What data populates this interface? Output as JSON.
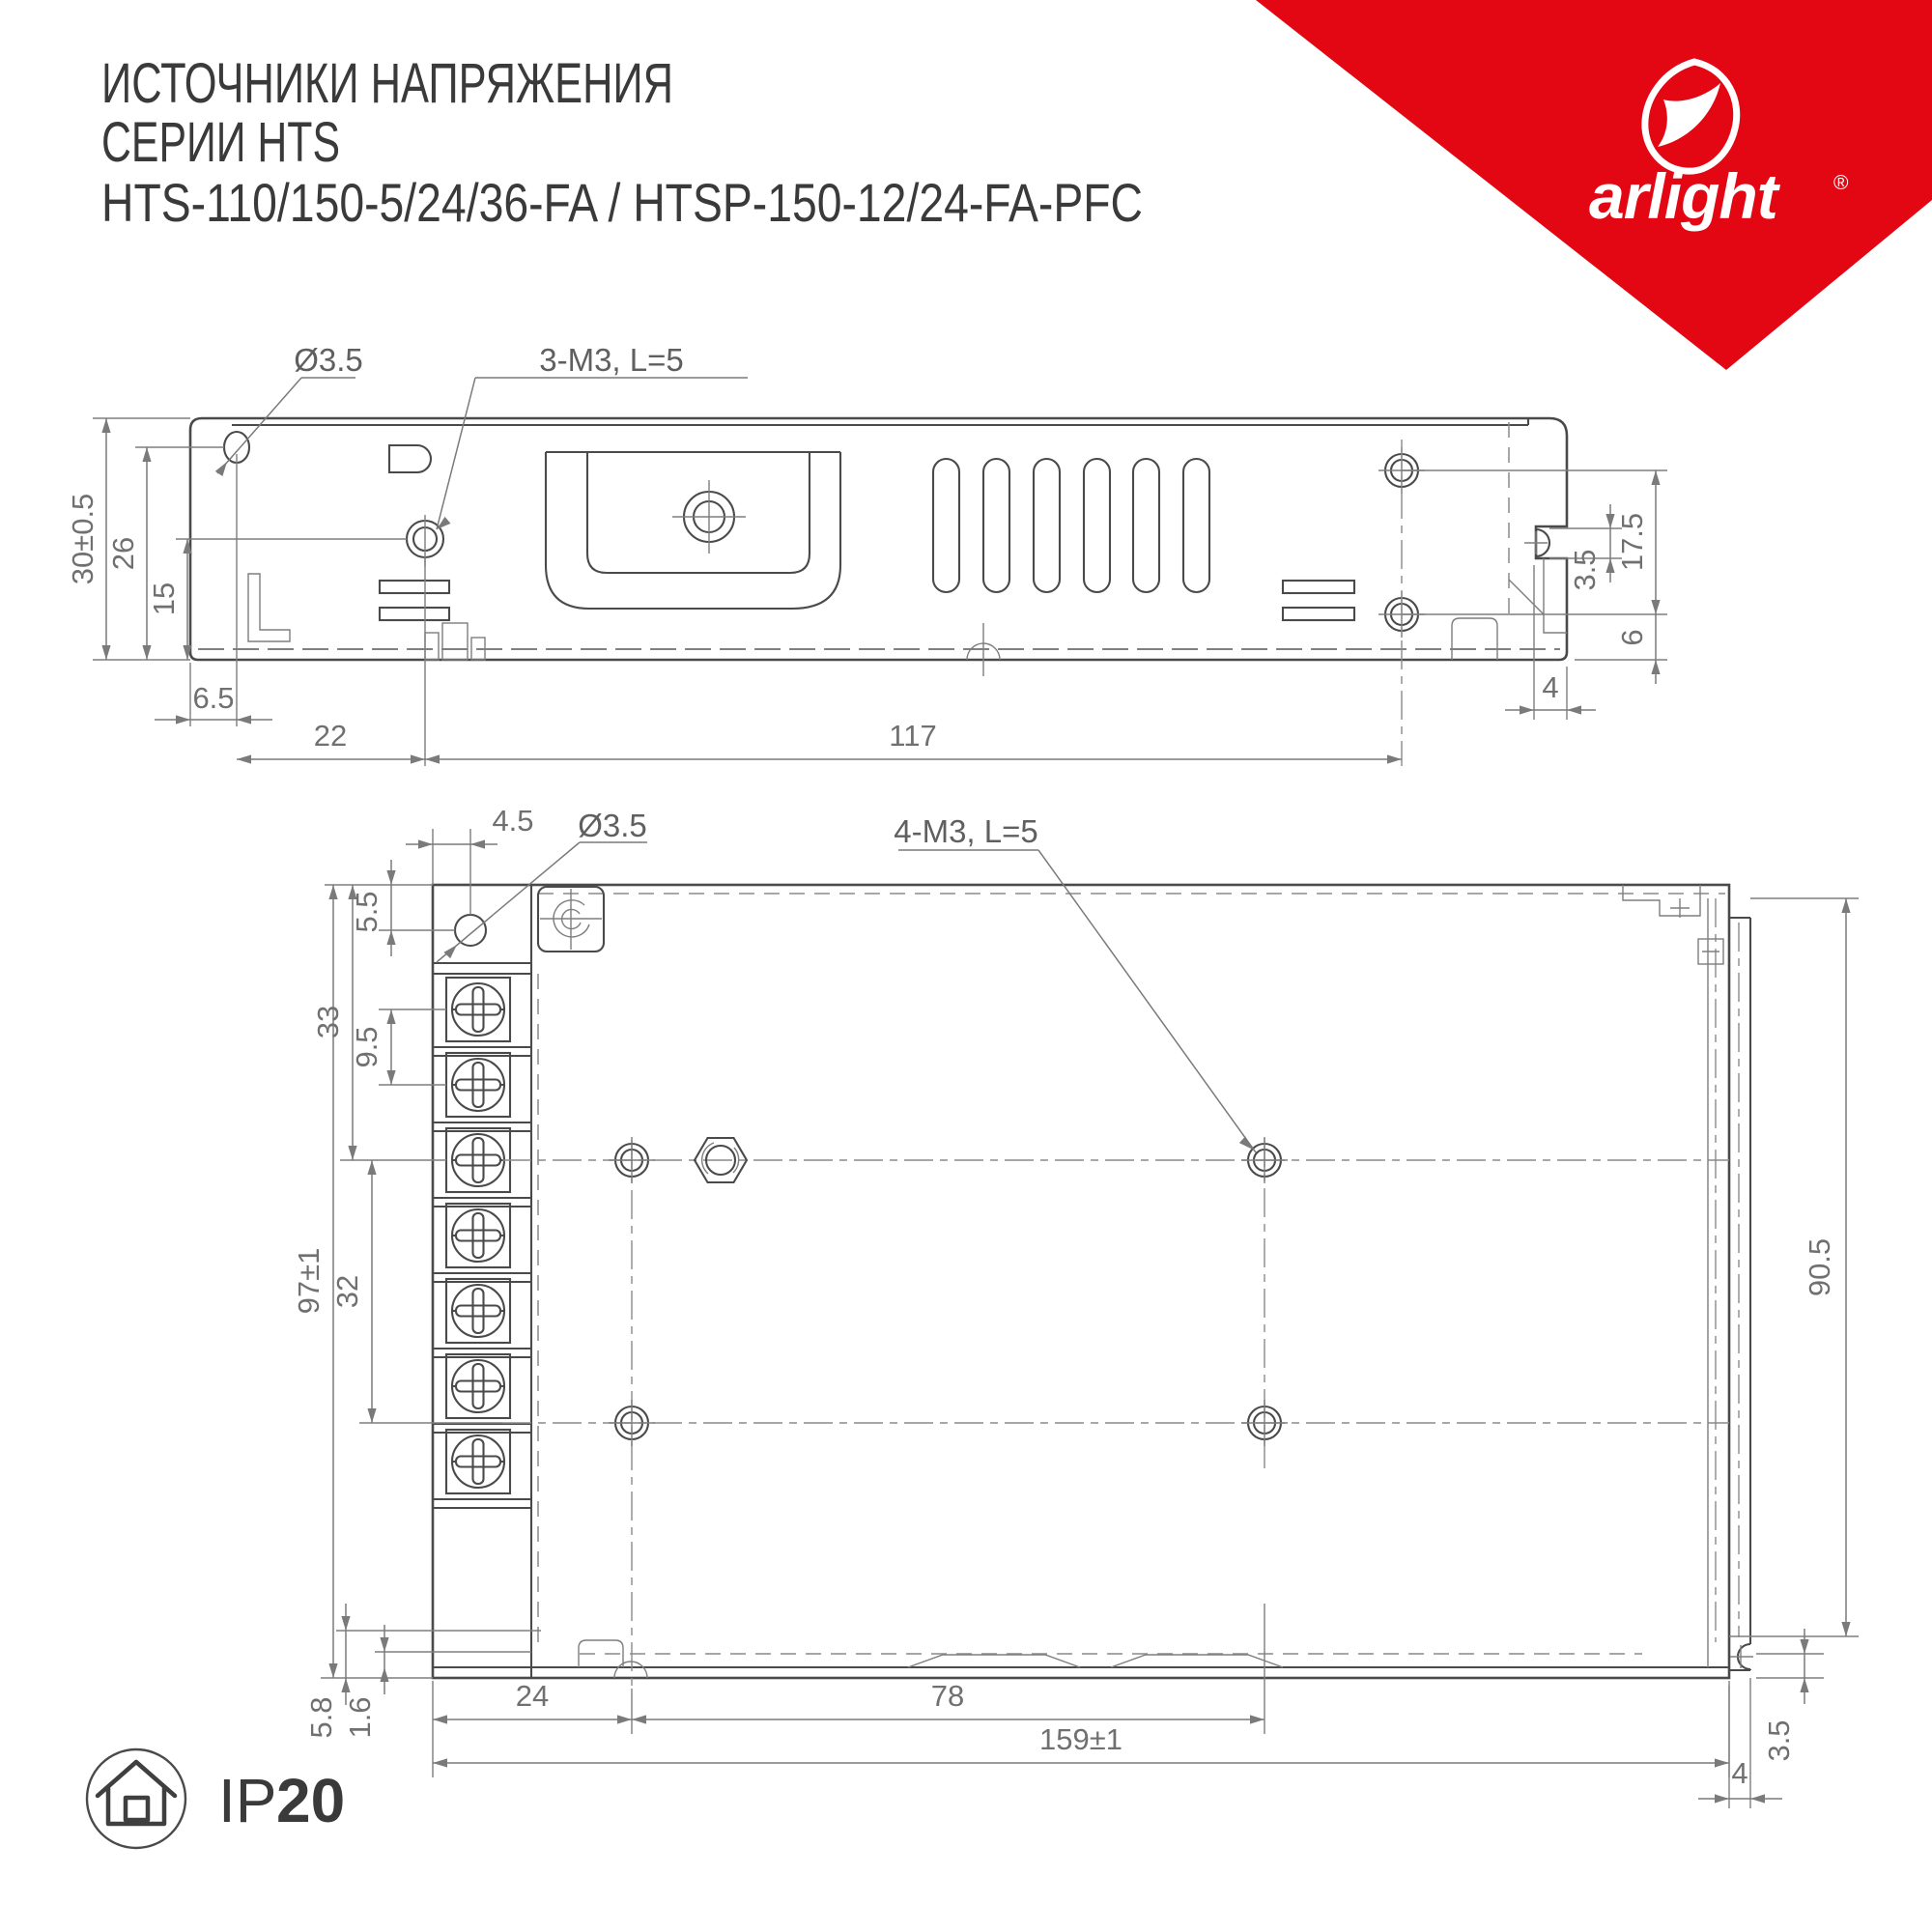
{
  "header": {
    "title_line1": "ИСТОЧНИКИ НАПРЯЖЕНИЯ",
    "title_line2": "СЕРИИ HTS",
    "title_line3": "HTS-110/150-5/24/36-FA / HTSP-150-12/24-FA-PFC"
  },
  "logo": {
    "brand": "arlight",
    "registered": "®"
  },
  "badge": {
    "ip": "IP",
    "rating": "20"
  },
  "colors": {
    "accent_red": "#e30613",
    "line": "#4a4a4a",
    "dim_text": "#707070"
  },
  "side_view": {
    "labels": {
      "hole_dia": "Ø3.5",
      "screw_note": "3-M3, L=5"
    },
    "dims": {
      "height": "30±0.5",
      "hole_to_bottom": "26",
      "key_to_bottom": "15",
      "edge_to_hole": "6.5",
      "hole_to_key": "22",
      "key_to_screws": "117",
      "screw_span": "17.5",
      "notch": "3.5",
      "screw_to_bottom": "6",
      "flange": "4"
    }
  },
  "bottom_view": {
    "labels": {
      "hole_dia": "Ø3.5",
      "screw_note": "4-M3, L=5"
    },
    "dims": {
      "edge_to_hole": "4.5",
      "hole_to_top": "5.5",
      "top_to_center": "33",
      "screw_pitch": "9.5",
      "height": "97±1",
      "center_span": "32",
      "right_height": "90.5",
      "foot": "5.8",
      "lip": "1.6",
      "edge_to_col": "24",
      "col_span": "78",
      "length": "159±1",
      "notch": "3.5",
      "flange": "4"
    }
  }
}
